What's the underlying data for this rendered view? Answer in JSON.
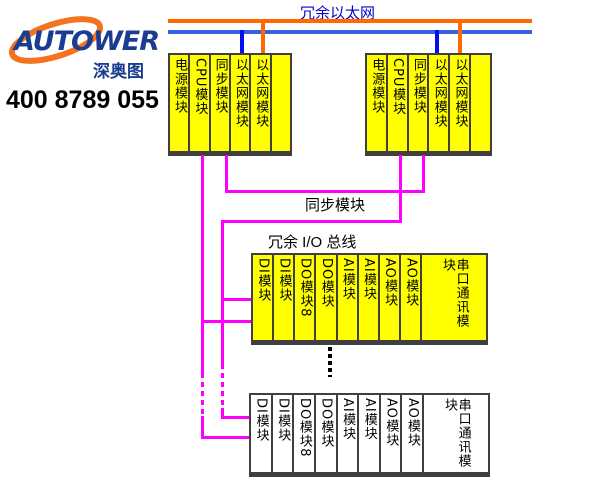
{
  "colors": {
    "eth_orange": "#FF6A00",
    "eth_blue": "#3A5FE0",
    "drop_blue": "#0010EE",
    "bus_magenta": "#FF00FF",
    "module_yellow": "#FFFF00",
    "module_border": "#3F3F3F",
    "label_blue": "#0000CC",
    "brand_navy": "#1B3D91",
    "brand_orange": "#F4731F",
    "text_black": "#000000"
  },
  "logo": {
    "brand": "AUTOWER",
    "cn_name": "深奥图",
    "phone": "400 8789 055"
  },
  "diagram": {
    "ethernet_label": "冗余以太网",
    "sync_label": "同步模块",
    "io_bus_label": "冗余 I/O 总线",
    "controller_rack_left": {
      "modules": [
        "电源模块",
        "CPU模块",
        "同步模块",
        "以太网模块",
        "以太网模块",
        ""
      ]
    },
    "controller_rack_right": {
      "modules": [
        "电源模块",
        "CPU模块",
        "同步模块",
        "以太网模块",
        "以太网模块",
        ""
      ]
    },
    "io_rack_top": {
      "modules": [
        "DI模块",
        "DI模块",
        "DO模块8",
        "DO模块",
        "AI模块",
        "AI模块",
        "AO模块",
        "AO模块",
        "串口通讯模块"
      ]
    },
    "io_rack_bottom": {
      "modules": [
        "DI模块",
        "DI模块",
        "DO模块8",
        "DO模块",
        "AI模块",
        "AI模块",
        "AO模块",
        "AO模块",
        "串口通讯模块"
      ]
    }
  }
}
